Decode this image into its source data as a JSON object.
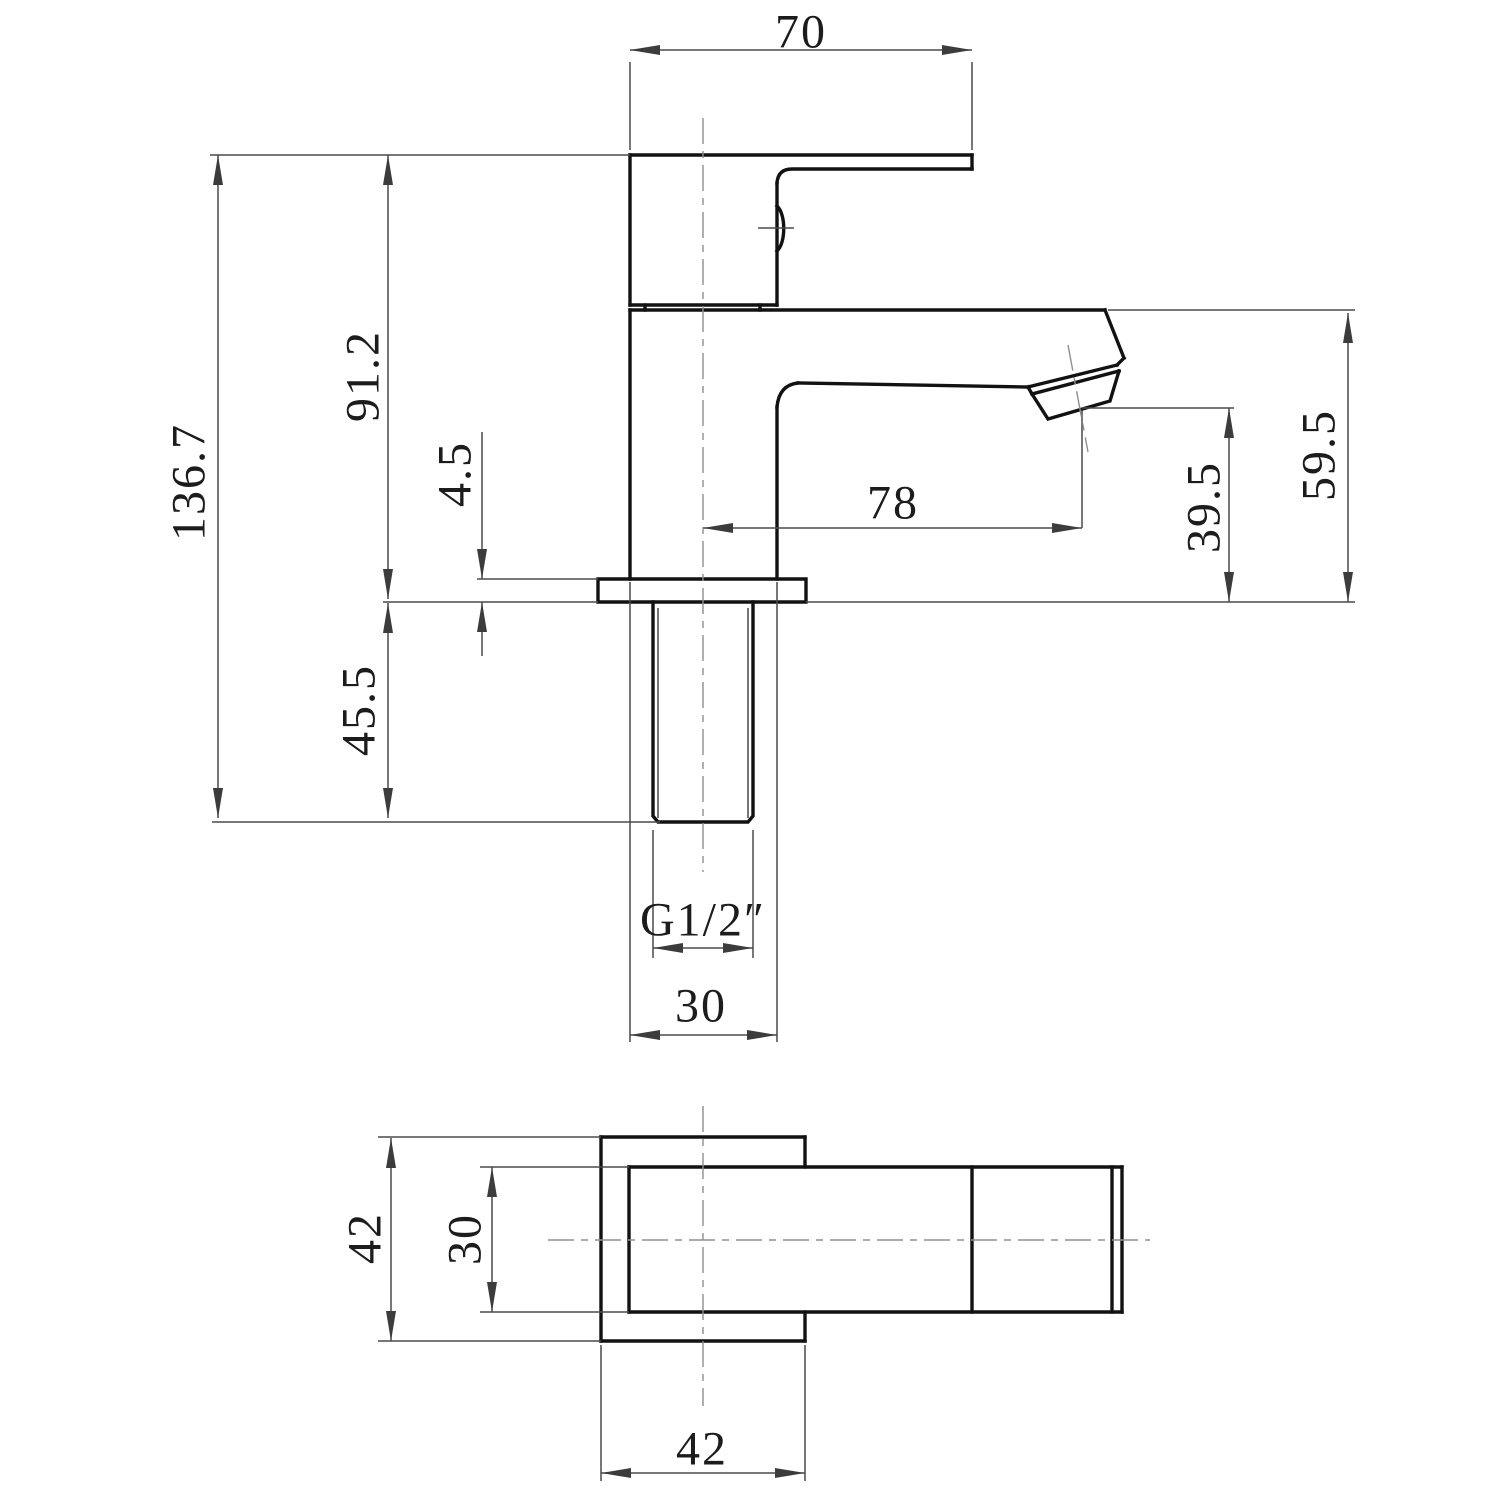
{
  "drawing": {
    "type": "technical-orthographic-drawing",
    "subject": "square single-lever basin tap",
    "views": [
      "side-elevation",
      "bottom-plan"
    ],
    "units": "mm"
  },
  "dimension_values": {
    "handle_top_width": "70",
    "overall_height": "136.7",
    "height_above_deck": "91.2",
    "flange_thickness": "4.5",
    "shank_length_below_deck": "45.5",
    "spout_reach": "78",
    "outlet_height_above_deck": "39.5",
    "spout_top_height_above_deck": "59.5",
    "thread_size": "G1/2″",
    "body_width": "30",
    "base_plate_width": "42",
    "base_body_width": "30",
    "base_plate_depth": "42"
  },
  "colors": {
    "outline": "#121212",
    "dimension": "#4a4a4a",
    "centerline": "#8f8f8f",
    "text": "#1c1c1c",
    "background": "#ffffff"
  },
  "labels": [
    {
      "id": "dim-70",
      "text": "70",
      "x": 801,
      "y": 32,
      "rot": 0
    },
    {
      "id": "dim-136-7",
      "text": "136.7",
      "x": 189,
      "y": 482,
      "rot": -90
    },
    {
      "id": "dim-91-2",
      "text": "91.2",
      "x": 363,
      "y": 376,
      "rot": -90
    },
    {
      "id": "dim-4-5",
      "text": "4.5",
      "x": 455,
      "y": 474,
      "rot": -90
    },
    {
      "id": "dim-45-5",
      "text": "45.5",
      "x": 359,
      "y": 710,
      "rot": -90
    },
    {
      "id": "dim-78",
      "text": "78",
      "x": 893,
      "y": 503,
      "rot": 0
    },
    {
      "id": "dim-39-5",
      "text": "39.5",
      "x": 1204,
      "y": 507,
      "rot": -90
    },
    {
      "id": "dim-59-5",
      "text": "59.5",
      "x": 1319,
      "y": 455,
      "rot": -90
    },
    {
      "id": "dim-thread",
      "text": "G1/2″",
      "x": 703,
      "y": 920,
      "rot": 0
    },
    {
      "id": "dim-30",
      "text": "30",
      "x": 701,
      "y": 1006,
      "rot": 0
    },
    {
      "id": "dim-42-l",
      "text": "42",
      "x": 365,
      "y": 1238,
      "rot": -90
    },
    {
      "id": "dim-30-l",
      "text": "30",
      "x": 465,
      "y": 1239,
      "rot": -90
    },
    {
      "id": "dim-42-b",
      "text": "42",
      "x": 702,
      "y": 1449,
      "rot": 0
    }
  ],
  "geometry": {
    "thick": [
      "M630,155 H972",
      "M972,155 V169",
      "M972,169 H792 Q778,169 777,183",
      "M777,183 V305",
      "M630,155 V305",
      "M630,305 H777",
      "M645,305 V310",
      "M760,305 V310",
      "M777,206 C786,214 786,243 777,251",
      "M630,310 H1105",
      "M1105,310 L1124,358",
      "M1124,358 L1117,365",
      "M1117,365 L1028,387",
      "M1119,371 L1032,394",
      "M1028,387 L1032,394",
      "M1032,394 L1048,419 L1110,401 L1119,371",
      "M798,383 L1028,387",
      "M798,383 Q779,385 777,407",
      "M777,407 V579",
      "M630,310 V579",
      "M598,579 H806 V602 H598 Z",
      "M653,602 V816 L658,822 H748 L753,816 V602",
      "M601,1137 H805",
      "M601,1137 V1341",
      "M601,1341 H805",
      "M805,1137 V1167",
      "M805,1312 V1341",
      "M629,1167 H1122",
      "M629,1312 H1122",
      "M629,1167 V1312",
      "M972,1167 V1312",
      "M1112,1167 V1312",
      "M1122,1167 V1312"
    ],
    "thin": [
      "M658,608 V818",
      "M748,608 V818",
      "M210,155 H630",
      "M212,822 H660",
      "M383,602 H598",
      "M806,602 H1355",
      "M477,579 H598",
      "M1108,310 H1355",
      "M1082,408 H1234",
      "M1082,410 V528",
      "M630,62 V150",
      "M972,62 V150",
      "M630,50 H972",
      "M218,155 V818",
      "M388,155 V599",
      "M388,603 V818",
      "M482,432 V579",
      "M482,602 V656",
      "M703,528 H1082",
      "M1229,408 V602",
      "M1348,313 V602",
      "M653,830 V958",
      "M753,830 V958",
      "M653,948 H753",
      "M630,582 V1042",
      "M777,582 V1042",
      "M630,1035 H777",
      "M758,228 H794",
      "M378,1137 H601",
      "M378,1341 H601",
      "M391,1138 V1341",
      "M480,1167 H629",
      "M480,1312 H629",
      "M492,1167 V1312",
      "M601,1345 V1481",
      "M805,1345 V1481",
      "M601,1473 H805"
    ],
    "center": [
      "M703,118 V872",
      "M703,1106 V1406",
      "M548,1240 H1150",
      "M1068,345 L1088,452"
    ],
    "arrows": [
      {
        "x": 630,
        "y": 50,
        "a": 180
      },
      {
        "x": 972,
        "y": 50,
        "a": 0
      },
      {
        "x": 218,
        "y": 155,
        "a": -90
      },
      {
        "x": 218,
        "y": 818,
        "a": 90
      },
      {
        "x": 388,
        "y": 155,
        "a": -90
      },
      {
        "x": 388,
        "y": 599,
        "a": 90
      },
      {
        "x": 388,
        "y": 603,
        "a": -90
      },
      {
        "x": 388,
        "y": 818,
        "a": 90
      },
      {
        "x": 482,
        "y": 579,
        "a": 90
      },
      {
        "x": 482,
        "y": 602,
        "a": -90
      },
      {
        "x": 703,
        "y": 528,
        "a": 180
      },
      {
        "x": 1082,
        "y": 528,
        "a": 0
      },
      {
        "x": 1229,
        "y": 408,
        "a": -90
      },
      {
        "x": 1229,
        "y": 602,
        "a": 90
      },
      {
        "x": 1348,
        "y": 313,
        "a": -90
      },
      {
        "x": 1348,
        "y": 602,
        "a": 90
      },
      {
        "x": 653,
        "y": 948,
        "a": 180
      },
      {
        "x": 753,
        "y": 948,
        "a": 0
      },
      {
        "x": 630,
        "y": 1035,
        "a": 180
      },
      {
        "x": 777,
        "y": 1035,
        "a": 0
      },
      {
        "x": 391,
        "y": 1138,
        "a": -90
      },
      {
        "x": 391,
        "y": 1341,
        "a": 90
      },
      {
        "x": 492,
        "y": 1167,
        "a": -90
      },
      {
        "x": 492,
        "y": 1312,
        "a": 90
      },
      {
        "x": 601,
        "y": 1473,
        "a": 180
      },
      {
        "x": 805,
        "y": 1473,
        "a": 0
      }
    ]
  }
}
